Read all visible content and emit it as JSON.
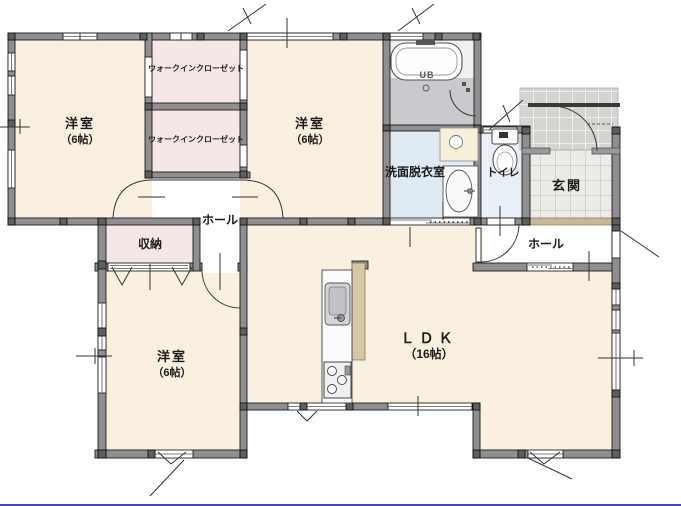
{
  "rooms": {
    "bedroom1": {
      "name": "洋室",
      "size": "（6帖）"
    },
    "bedroom2": {
      "name": "洋室",
      "size": "（6帖）"
    },
    "bedroom3": {
      "name": "洋室",
      "size": "（6帖）"
    },
    "ldk": {
      "name": "ＬＤＫ",
      "size": "（16帖）"
    },
    "wic1": {
      "name": "ウォークインクローゼット"
    },
    "wic2": {
      "name": "ウォークインクローゼット"
    },
    "washroom": {
      "name": "洗面脱衣室"
    },
    "toilet": {
      "name": "トイレ"
    },
    "entrance": {
      "name": "玄関"
    },
    "hall_center": {
      "name": "ホール"
    },
    "hall_entrance": {
      "name": "ホール"
    },
    "storage": {
      "name": "収納"
    },
    "bath": {
      "name": "UB"
    }
  },
  "colors": {
    "wall": "#8f8f8f",
    "room_floor": "#faf0e0",
    "closet_floor": "#f6e7e7",
    "washroom_floor": "#dfeaf4",
    "toilet_floor": "#e9eff6",
    "bath_floor": "#c9cacd",
    "entrance_step": "#c9b69b",
    "kitchen_panel": "#d8c7a3",
    "bottom_border": "#4444c8"
  }
}
